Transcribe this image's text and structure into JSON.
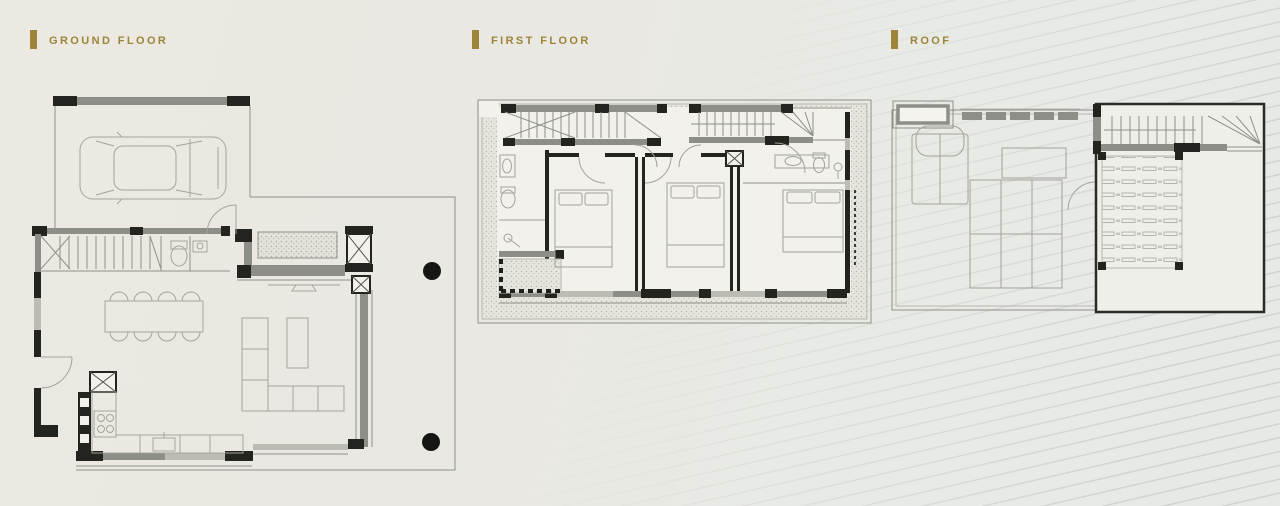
{
  "page": {
    "background_left": "#ebe8e1",
    "background_right": "#e7eae6",
    "stripe_color": "rgba(158,166,156,0.30)"
  },
  "colors": {
    "accent_gold": "#9d8438",
    "wall_dark": "#23231f",
    "wall_gray": "#8e8e88",
    "plan_line": "#8f8f89",
    "furniture_line": "#a3a39c",
    "tree_dot": "#161614"
  },
  "sections": [
    {
      "id": "ground-floor",
      "label": "GROUND FLOOR"
    },
    {
      "id": "first-floor",
      "label": "FIRST FLOOR"
    },
    {
      "id": "roof",
      "label": "ROOF"
    }
  ]
}
